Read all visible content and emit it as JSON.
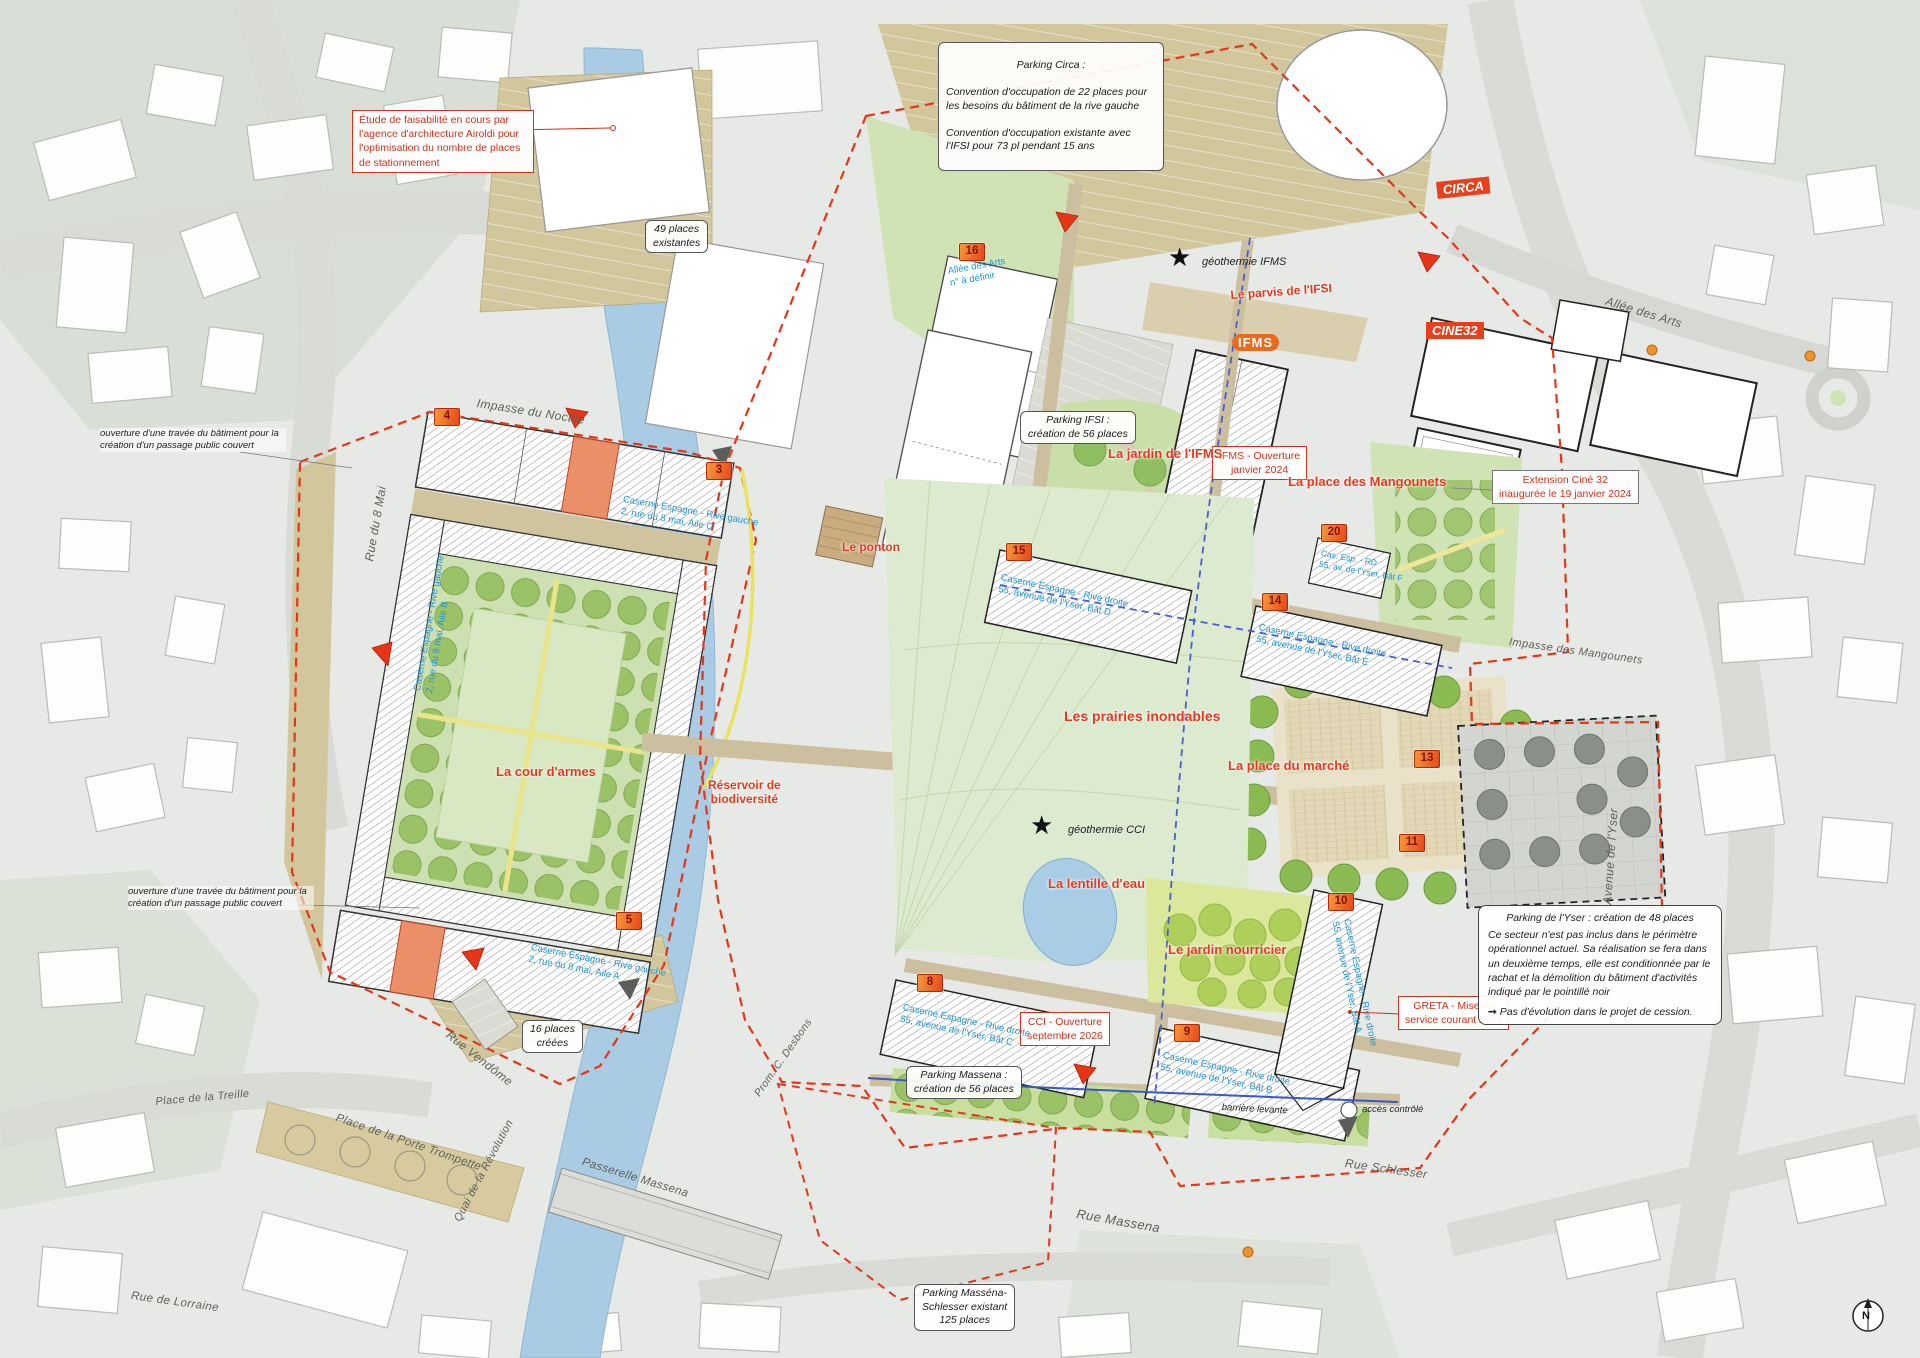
{
  "annotations": {
    "etude": "Étude de faisabilité en cours par l'agence d'architecture Airoldi pour l'optimisation du nombre de places de stationnement",
    "circa_title": "Parking Circa :",
    "circa_line1": "Convention d'occupation de 22 places pour les besoins du bâtiment de la rive gauche",
    "circa_line2": "Convention d'occupation existante avec l'IFSI pour 73 pl pendant 15 ans",
    "places49": "49 places\nexistantes",
    "places16": "16 places\ncréées",
    "ouverture": "ouverture d'une travée du bâtiment pour la\ncréation d'un passage public couvert",
    "parking_ifsi": "Parking IFSI :\ncréation de 56 places",
    "ifms_ouverture": "IFMS - Ouverture\njanvier 2024",
    "extension_cine": "Extension Ciné 32\ninaugurée le 19 janvier 2024",
    "cci": "CCI - Ouverture\nseptembre 2026",
    "greta": "GRETA - Mise en\nservice courant 2026",
    "parking_massena": "Parking Massena :\ncréation de 56 places",
    "massena_schlesser": "Parking Masséna-\nSchlesser existant\n125 places",
    "yser_title": "Parking de l'Yser : création de 48 places",
    "yser_body": "Ce secteur n'est pas inclus dans le périmètre opérationnel actuel. Sa réalisation se fera dans un deuxième temps, elle est conditionnée par le rachat et la démolition du bâtiment d'activités indiqué par le pointillé noir",
    "yser_note": "Pas d'évolution dans le projet de cession.",
    "barriere": "barrière levante",
    "acces": "accès contrôlé",
    "geo_ifms": "géothermie IFMS",
    "geo_cci": "géothermie CCI"
  },
  "red_labels": {
    "parvis": "Le parvis de l'IFSI",
    "jardin_ifms": "La jardin de l'IFMS",
    "mangounets": "La place des Mangounets",
    "prairies": "Les prairies inondables",
    "marche": "La place du marché",
    "lentille": "La lentille d'eau",
    "nourricier": "Le jardin nourricier",
    "cour": "La cour d'armes",
    "reservoir": "Réservoir de\nbiodiversité",
    "ponton": "Le ponton"
  },
  "badges": {
    "circa": "CIRCA",
    "cine": "CINE32",
    "ifms": "IFMS"
  },
  "streets": {
    "noctile": "Impasse du Noctile",
    "mai8": "Rue du 8 Mai",
    "arts": "Allée des Arts",
    "imp_mangounets": "Impasse des Mangounets",
    "yser": "Avenue de l'Yser",
    "schlesser": "Rue Schlesser",
    "massena": "Rue Massena",
    "vendome": "Rue Vendôme",
    "treille": "Place de la Treille",
    "trompette": "Place de la Porte Trompette",
    "quai": "Quai de la Révolution",
    "passerelle": "Passerelle Massena",
    "prom": "Prom. C. Desbons",
    "lorraine": "Rue de Lorraine"
  },
  "markers": {
    "m3": {
      "num": "3"
    },
    "m4": {
      "num": "4"
    },
    "m5": {
      "num": "5",
      "label": "Caserne Espagne - Rive gauche\n2, rue du 8 mai, Aile A"
    },
    "m8": {
      "num": "8",
      "label": "Caserne Espagne - Rive droite\n55, avenue de l'Yser, Bât C"
    },
    "m9": {
      "num": "9",
      "label": "Caserne Espagne - Rive droite\n55, avenue de l'Yser, Bât B"
    },
    "m10": {
      "num": "10",
      "label": "Caserne Espagne - Rive droite\n55, avenue de l'Yser, Bât A"
    },
    "m11": {
      "num": "11"
    },
    "m13": {
      "num": "13"
    },
    "m14": {
      "num": "14",
      "label": "Caserne Espagne - Rive droite\n55, avenue de l'Yser, Bât E"
    },
    "m15": {
      "num": "15",
      "label": "Caserne Espagne - Rive droite\n55, avenue de l'Yser, Bât D"
    },
    "m16": {
      "num": "16",
      "label": "Allée des Arts\nn° à définir"
    },
    "m20": {
      "num": "20",
      "label": "Cas. Esp. - RD\n55, av. de l'Yser, Bât F"
    }
  },
  "buildings": {
    "aile_b": "Caserne Espagne - Rive gauche\n2, rue du 8 mai, Aile B",
    "aile_c": "Caserne Espagne - Rive gauche\n2, rue du 8 mai, Aile C"
  },
  "compass": {
    "n": "N"
  },
  "colors": {
    "boundary_red": "#e63517",
    "boundary_blue": "#4a5ed0",
    "label_blue": "#2196d6",
    "label_red": "#e8391d",
    "parking_tan": "#d2c79c",
    "park_green": "#cfe3b4",
    "river_blue": "#a9cbe3"
  }
}
